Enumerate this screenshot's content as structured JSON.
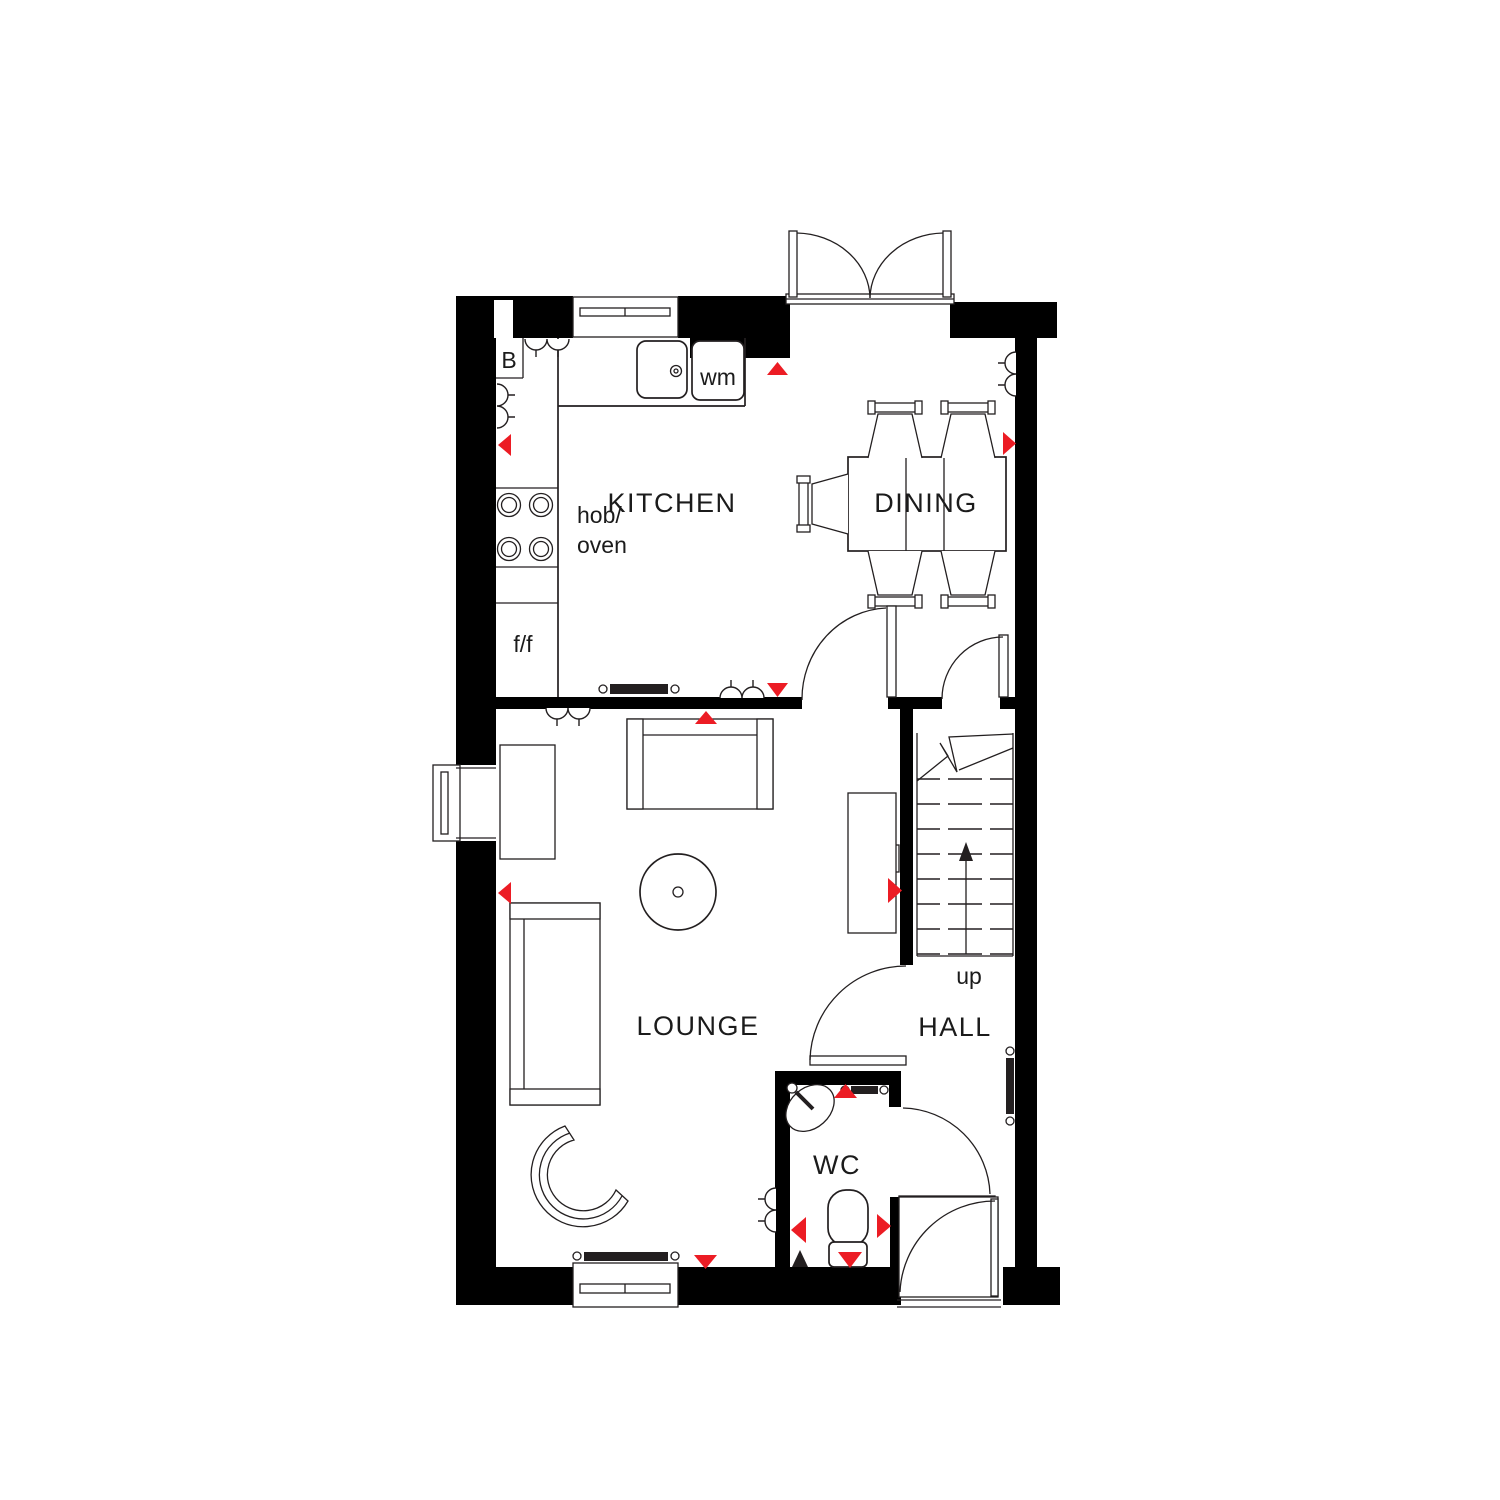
{
  "meta": {
    "drawing_type": "house ground floor plan"
  },
  "colors": {
    "background": "#FFFFFF",
    "wall": "#000000",
    "line": "#231F20",
    "accent_red": "#EC1C24"
  },
  "rooms": {
    "kitchen": "KITCHEN",
    "dining": "DINING",
    "lounge": "LOUNGE",
    "hall": "HALL",
    "wc": "WC"
  },
  "fixtures": {
    "boiler": "B",
    "washing_machine": "wm",
    "hob_line1": "hob/",
    "hob_line2": "oven",
    "fridge_freezer": "f/f",
    "stairs_direction": "up",
    "meter_line1": "M",
    "meter_line2": "P"
  }
}
